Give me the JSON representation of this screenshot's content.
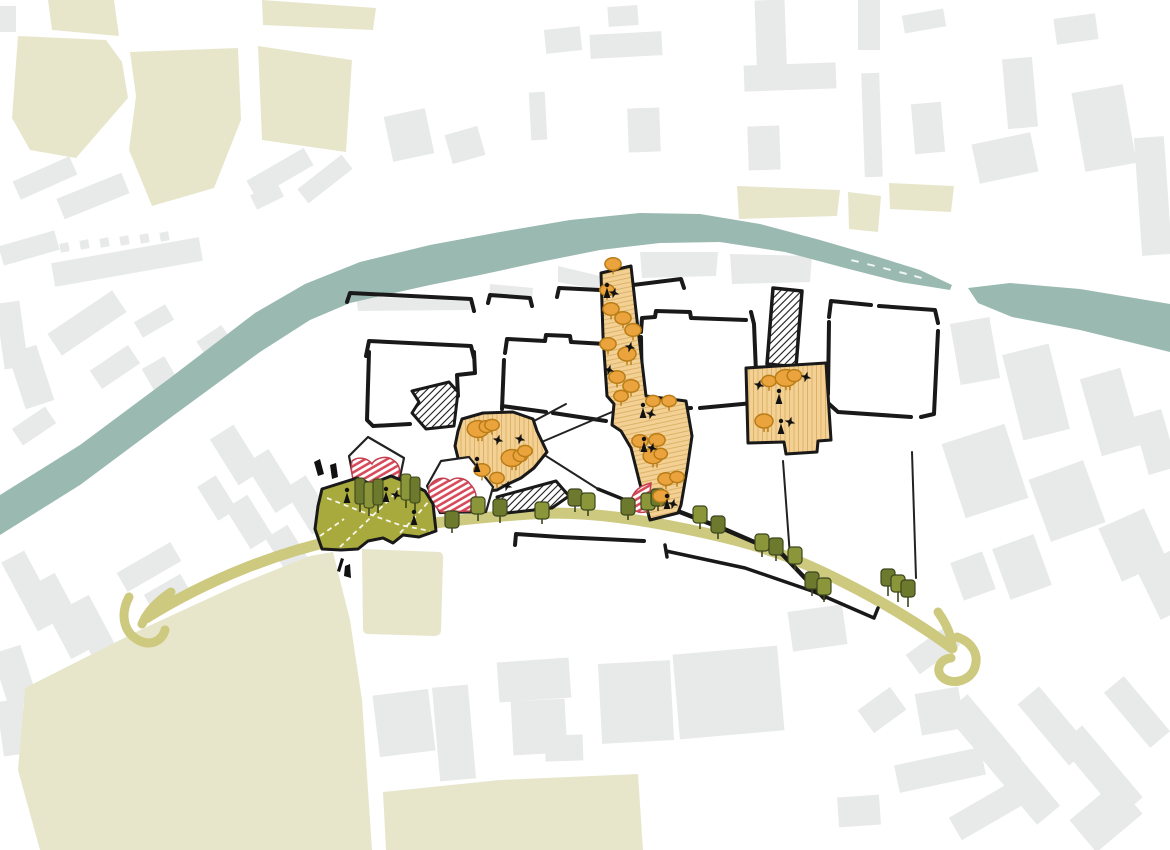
{
  "title": "Riverside urban masterplan sketch",
  "colors": {
    "bg": "#ffffff",
    "context_building": "#e8eae9",
    "greenspace": "#e7e6cb",
    "river": "#9ab9b0",
    "route": "#cdc97e",
    "public_green": "#a9aa3d",
    "tan": "#f3d195",
    "tan_hatch": "#ddb268",
    "tree_orange": "#eba43d",
    "tree_orange_dark": "#b97c16",
    "tree_olive_dark": "#6d7a2e",
    "tree_olive_mid": "#8a9639",
    "tree_outline": "#3c461d",
    "red": "#d8495a",
    "red_outline": "#c2404f",
    "ink": "#191919"
  },
  "markers": {
    "orange_trees": [
      [
        478,
        429,
        1.2,
        1
      ],
      [
        492,
        425,
        0.8,
        0
      ],
      [
        512,
        458,
        1.2,
        1
      ],
      [
        525,
        451,
        0.8,
        0
      ],
      [
        482,
        470,
        0.9,
        0
      ],
      [
        497,
        478,
        0.8,
        0
      ],
      [
        613,
        264,
        0.9,
        0
      ],
      [
        607,
        290,
        0.8,
        0
      ],
      [
        611,
        309,
        0.9,
        0
      ],
      [
        623,
        318,
        0.9,
        0
      ],
      [
        633,
        330,
        0.9,
        0
      ],
      [
        608,
        344,
        0.9,
        0
      ],
      [
        627,
        354,
        1.0,
        0
      ],
      [
        617,
        377,
        0.9,
        0
      ],
      [
        631,
        386,
        0.9,
        0
      ],
      [
        621,
        396,
        0.8,
        0
      ],
      [
        653,
        401,
        0.8,
        0
      ],
      [
        669,
        401,
        0.8,
        0
      ],
      [
        640,
        441,
        0.9,
        0
      ],
      [
        657,
        440,
        0.9,
        0
      ],
      [
        653,
        456,
        1.1,
        1
      ],
      [
        666,
        479,
        0.9,
        0
      ],
      [
        677,
        477,
        0.8,
        0
      ],
      [
        661,
        496,
        0.9,
        0
      ],
      [
        769,
        381,
        0.8,
        0
      ],
      [
        786,
        378,
        1.2,
        1
      ],
      [
        764,
        421,
        1.0,
        0
      ]
    ],
    "street_trees": [
      [
        452,
        520,
        0,
        6
      ],
      [
        478,
        506,
        1,
        8
      ],
      [
        500,
        508,
        0,
        8
      ],
      [
        542,
        511,
        1,
        6
      ],
      [
        575,
        498,
        0,
        7
      ],
      [
        588,
        502,
        1,
        7
      ],
      [
        628,
        507,
        0,
        6
      ],
      [
        648,
        502,
        1,
        6
      ],
      [
        658,
        498,
        0,
        6
      ],
      [
        700,
        515,
        1,
        7
      ],
      [
        718,
        525,
        0,
        7
      ],
      [
        762,
        543,
        1,
        7
      ],
      [
        776,
        547,
        0,
        7
      ],
      [
        795,
        556,
        1,
        7
      ],
      [
        812,
        581,
        0,
        8
      ],
      [
        824,
        587,
        1,
        8
      ],
      [
        888,
        578,
        0,
        11
      ],
      [
        898,
        584,
        1,
        11
      ],
      [
        908,
        589,
        0,
        11
      ]
    ],
    "tall_trees": [
      [
        360,
        492
      ],
      [
        369,
        496
      ],
      [
        378,
        493
      ],
      [
        406,
        488
      ],
      [
        415,
        491
      ]
    ],
    "people": [
      [
        347,
        497
      ],
      [
        386,
        496
      ],
      [
        414,
        519
      ],
      [
        477,
        466
      ],
      [
        607,
        292
      ],
      [
        643,
        412
      ],
      [
        644,
        446
      ],
      [
        667,
        503
      ],
      [
        779,
        398
      ],
      [
        781,
        428
      ]
    ],
    "stars": [
      [
        396,
        495
      ],
      [
        498,
        440
      ],
      [
        520,
        439
      ],
      [
        507,
        486
      ],
      [
        614,
        293
      ],
      [
        651,
        414
      ],
      [
        652,
        448
      ],
      [
        673,
        504
      ],
      [
        630,
        347
      ],
      [
        609,
        370
      ],
      [
        759,
        385
      ],
      [
        790,
        422
      ],
      [
        806,
        377
      ]
    ],
    "river_dashes": [
      [
        855,
        261,
        12
      ],
      [
        871,
        265,
        13
      ],
      [
        887,
        269,
        14
      ],
      [
        903,
        273,
        15
      ],
      [
        918,
        277,
        16
      ]
    ]
  },
  "context_buildings": [
    [
      0,
      6,
      16,
      26,
      0
    ],
    [
      148,
      148,
      22,
      18,
      -20
    ],
    [
      14,
      168,
      62,
      20,
      -24
    ],
    [
      58,
      185,
      70,
      22,
      -22
    ],
    [
      0,
      238,
      58,
      20,
      -16
    ],
    [
      52,
      250,
      150,
      24,
      -10
    ],
    [
      247,
      163,
      66,
      20,
      -30
    ],
    [
      297,
      170,
      56,
      18,
      -38
    ],
    [
      252,
      188,
      30,
      16,
      -26
    ],
    [
      60,
      243,
      9,
      9,
      -10
    ],
    [
      80,
      240,
      9,
      9,
      -10
    ],
    [
      100,
      238,
      9,
      9,
      -10
    ],
    [
      120,
      236,
      9,
      9,
      -10
    ],
    [
      140,
      234,
      9,
      9,
      -10
    ],
    [
      160,
      232,
      9,
      9,
      -10
    ],
    [
      388,
      112,
      42,
      46,
      -12
    ],
    [
      448,
      130,
      34,
      30,
      -16
    ],
    [
      545,
      28,
      36,
      24,
      -6
    ],
    [
      608,
      6,
      30,
      20,
      -4
    ],
    [
      530,
      92,
      16,
      48,
      -3
    ],
    [
      590,
      33,
      72,
      24,
      -3
    ],
    [
      756,
      0,
      30,
      86,
      -2
    ],
    [
      744,
      64,
      92,
      26,
      -2
    ],
    [
      628,
      108,
      32,
      44,
      -2
    ],
    [
      748,
      126,
      32,
      44,
      -2
    ],
    [
      858,
      0,
      22,
      50,
      0
    ],
    [
      863,
      73,
      18,
      104,
      -2
    ],
    [
      903,
      12,
      42,
      18,
      -10
    ],
    [
      913,
      103,
      30,
      50,
      -5
    ],
    [
      1005,
      58,
      30,
      70,
      -5
    ],
    [
      1055,
      16,
      42,
      26,
      -8
    ],
    [
      1078,
      88,
      52,
      80,
      -10
    ],
    [
      975,
      138,
      60,
      40,
      -12
    ],
    [
      1138,
      137,
      30,
      118,
      -4
    ],
    [
      0,
      302,
      24,
      66,
      -8
    ],
    [
      16,
      348,
      30,
      58,
      -18
    ],
    [
      48,
      310,
      78,
      26,
      -34
    ],
    [
      92,
      356,
      46,
      22,
      -34
    ],
    [
      136,
      312,
      36,
      18,
      -30
    ],
    [
      14,
      416,
      40,
      20,
      -34
    ],
    [
      205,
      330,
      30,
      40,
      -34
    ],
    [
      150,
      360,
      26,
      40,
      -30
    ],
    [
      18,
      552,
      26,
      78,
      -28
    ],
    [
      50,
      574,
      26,
      84,
      -28
    ],
    [
      84,
      596,
      26,
      84,
      -28
    ],
    [
      118,
      556,
      62,
      22,
      -30
    ],
    [
      146,
      583,
      42,
      20,
      -30
    ],
    [
      0,
      648,
      30,
      58,
      -18
    ],
    [
      0,
      700,
      26,
      55,
      -8
    ],
    [
      222,
      428,
      28,
      54,
      -32
    ],
    [
      258,
      452,
      28,
      58,
      -32
    ],
    [
      296,
      478,
      26,
      54,
      -32
    ],
    [
      236,
      498,
      26,
      48,
      -32
    ],
    [
      276,
      528,
      26,
      48,
      -32
    ],
    [
      206,
      478,
      22,
      40,
      -32
    ],
    [
      376,
      692,
      56,
      62,
      -7
    ],
    [
      436,
      686,
      36,
      94,
      -5
    ],
    [
      498,
      660,
      72,
      40,
      -4
    ],
    [
      512,
      700,
      54,
      54,
      -3
    ],
    [
      545,
      735,
      38,
      26,
      -2
    ],
    [
      600,
      662,
      72,
      80,
      -3
    ],
    [
      676,
      650,
      105,
      85,
      -5
    ],
    [
      790,
      608,
      55,
      40,
      -8
    ],
    [
      955,
      320,
      40,
      62,
      -10
    ],
    [
      1012,
      348,
      48,
      88,
      -14
    ],
    [
      1090,
      372,
      42,
      80,
      -16
    ],
    [
      1140,
      412,
      30,
      60,
      -16
    ],
    [
      952,
      432,
      66,
      78,
      -18
    ],
    [
      1038,
      468,
      58,
      66,
      -20
    ],
    [
      1108,
      516,
      50,
      58,
      -24
    ],
    [
      1000,
      540,
      44,
      54,
      -20
    ],
    [
      1146,
      556,
      40,
      58,
      -26
    ],
    [
      956,
      556,
      34,
      40,
      -20
    ],
    [
      908,
      638,
      50,
      24,
      -36
    ],
    [
      968,
      694,
      30,
      84,
      -40
    ],
    [
      1004,
      734,
      30,
      92,
      -40
    ],
    [
      1040,
      686,
      28,
      80,
      -40
    ],
    [
      1086,
      724,
      30,
      94,
      -40
    ],
    [
      1124,
      676,
      26,
      72,
      -40
    ],
    [
      896,
      756,
      88,
      28,
      -12
    ],
    [
      950,
      796,
      80,
      26,
      -30
    ],
    [
      1076,
      796,
      60,
      42,
      -40
    ],
    [
      838,
      796,
      42,
      30,
      -4
    ],
    [
      862,
      696,
      40,
      28,
      -36
    ],
    [
      918,
      690,
      44,
      42,
      -10
    ]
  ]
}
